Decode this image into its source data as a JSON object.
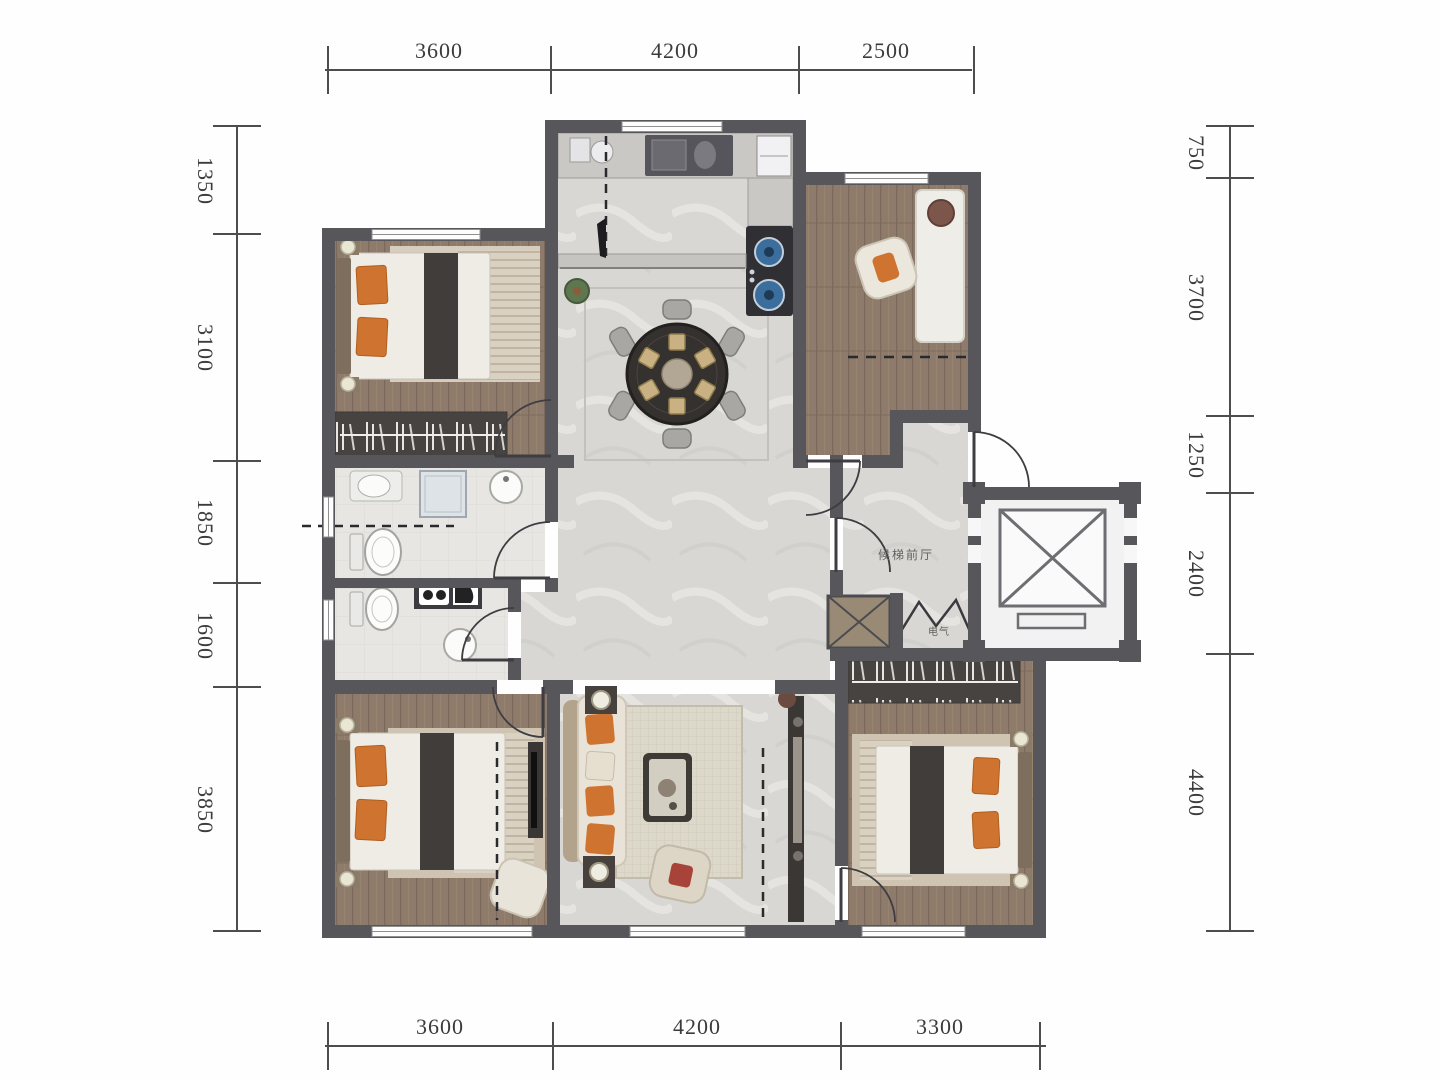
{
  "floorplan": {
    "dims": {
      "top": [
        "3600",
        "4200",
        "2500"
      ],
      "bottom": [
        "3600",
        "4200",
        "3300"
      ],
      "left": [
        "1350",
        "3100",
        "1850",
        "1600",
        "3850"
      ],
      "right": [
        "750",
        "3700",
        "1250",
        "2400",
        "4400"
      ]
    },
    "labels": {
      "elevator_lobby": "候梯前厅",
      "electrical": "电气"
    },
    "colors": {
      "wall": "#56565b",
      "wood_floor": "#8e7b6b",
      "marble_floor": "#d8d7d4",
      "bath_tile": "#e7e6e2",
      "accent_orange": "#cf7430",
      "dim_text": "#3b3b3b"
    }
  }
}
